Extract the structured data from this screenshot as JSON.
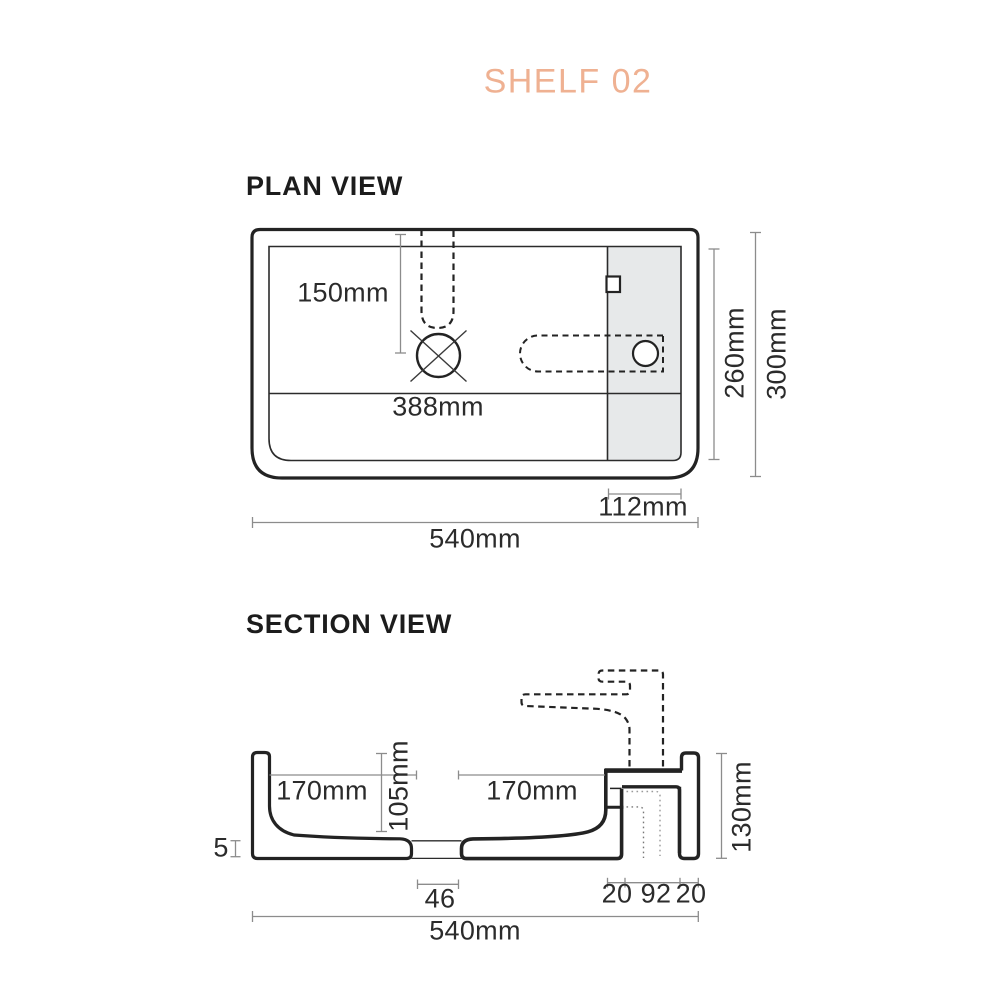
{
  "title": "SHELF 02",
  "plan_view": {
    "heading": "PLAN VIEW",
    "dimensions": {
      "d150": "150mm",
      "d388": "388mm",
      "d260": "260mm",
      "d300": "300mm",
      "d112": "112mm",
      "d540": "540mm"
    }
  },
  "section_view": {
    "heading": "SECTION VIEW",
    "dimensions": {
      "d170l": "170mm",
      "d105": "105mm",
      "d170r": "170mm",
      "d130": "130mm",
      "d5": "5",
      "d46": "46",
      "d20a": "20",
      "d92": "92",
      "d20b": "20",
      "d540": "540mm"
    }
  },
  "colors": {
    "accent": "#efb192",
    "line": "#232323",
    "dim": "#8c8c8c",
    "text": "#2b2b2b",
    "shade": "#e7e9ea"
  }
}
